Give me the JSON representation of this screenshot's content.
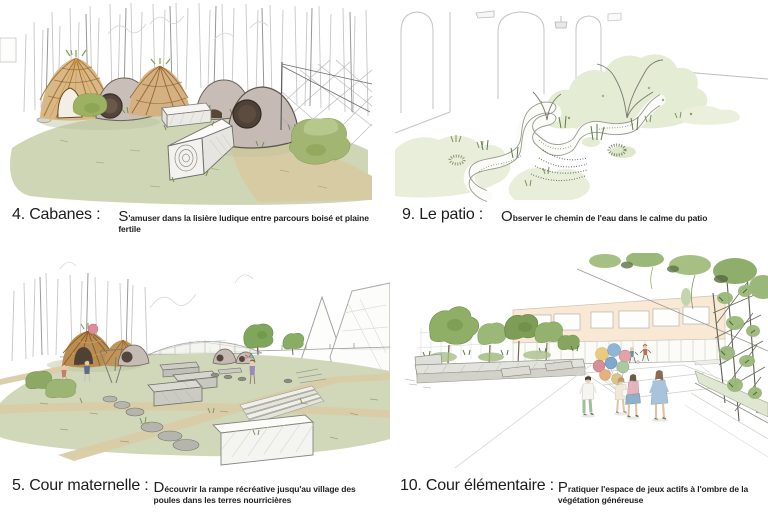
{
  "figures": [
    {
      "label": "4. Cabanes :",
      "desc_initial": "S",
      "desc_rest": "'amuser dans la lisière ludique entre parcours boisé et plaine fertile"
    },
    {
      "label": "9. Le patio :",
      "desc_initial": "O",
      "desc_rest": "bserver le chemin de l'eau dans le calme du patio"
    },
    {
      "label": "5. Cour maternelle :",
      "desc_initial": "D",
      "desc_rest": "écouvrir la rampe récréative jusqu'au village des poules dans les terres nourricières"
    },
    {
      "label": "10. Cour élémentaire :",
      "desc_initial": "P",
      "desc_rest": "ratiquer l'espace de jeux actifs à l'ombre de la végétation généreuse"
    }
  ],
  "colors": {
    "text": "#1d1d1d",
    "ground_sage": "#cfd6b5",
    "path_tan": "#d7cba3",
    "wicker_orange": "#c08a45",
    "dome_gray": "#c6bcb4",
    "vegetation_pale": "#e8eed9",
    "bush_olive": "#9db163",
    "facade_peach": "#f8e8d4",
    "balloon_pink": "#e08a9b",
    "balloon_blue": "#8fb6d8",
    "balloon_yellow": "#e8cc7c",
    "balloon_green": "#a9c9a2"
  }
}
